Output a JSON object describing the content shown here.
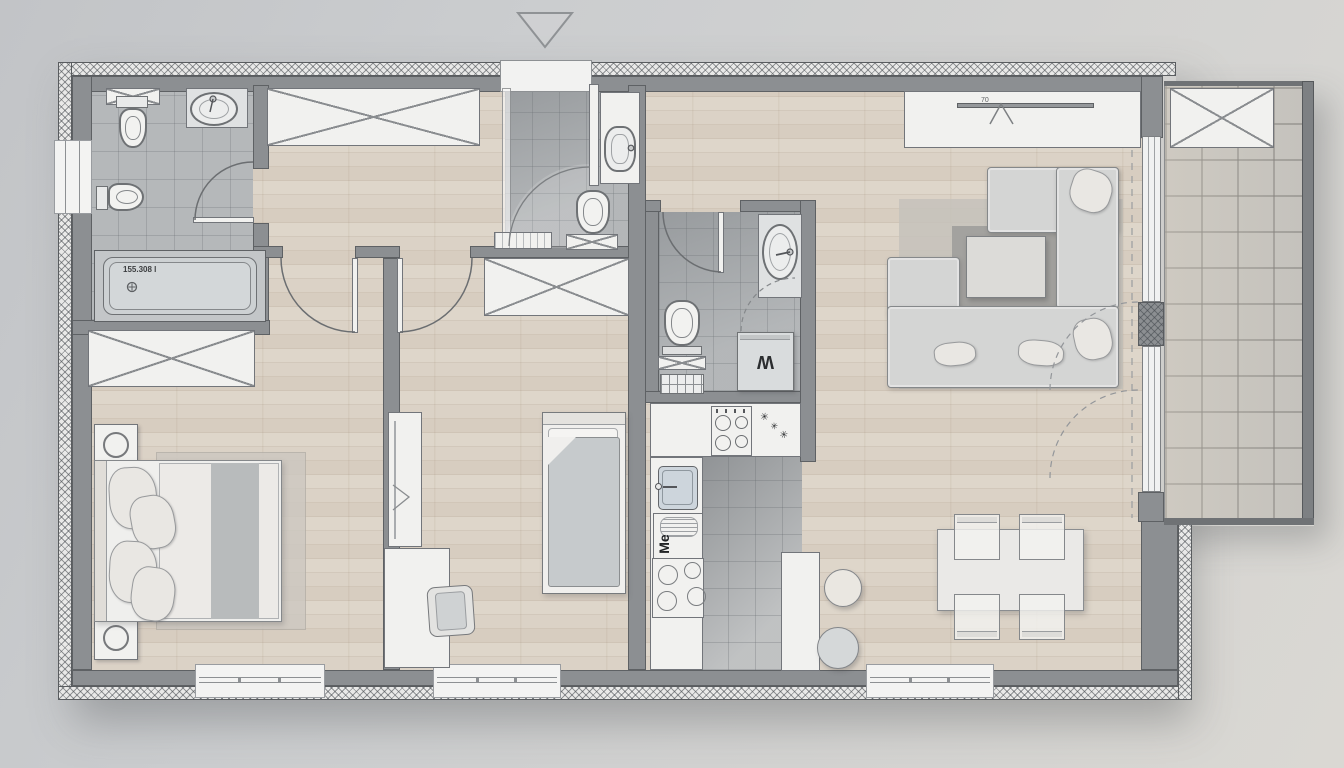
{
  "plan": {
    "labels": {
      "bathtub_capacity": "155.308 l",
      "washing_machine": "W",
      "dishwasher_brand": "Me",
      "tv_size": "70",
      "spice_mark": "✳"
    },
    "colors": {
      "outside_background": "#cdcfd1",
      "wall_gray": "#8c8f92",
      "wall_outline": "#5e6164",
      "insulation_hatch_bg": "#e9e9e8",
      "wood_floor": "#d8cec2",
      "bathroom_tile": "#b5b8ba",
      "kitchen_tile": "#a9acaf",
      "balcony_tile": "#cac7c0",
      "furniture_white": "#f1f1ef",
      "sofa_gray": "#d4d5d4",
      "rug_gray": "#c6c2bb",
      "appliance_gray": "#d9dcdd",
      "sink_basin_blue": "#cdd5dc"
    }
  }
}
